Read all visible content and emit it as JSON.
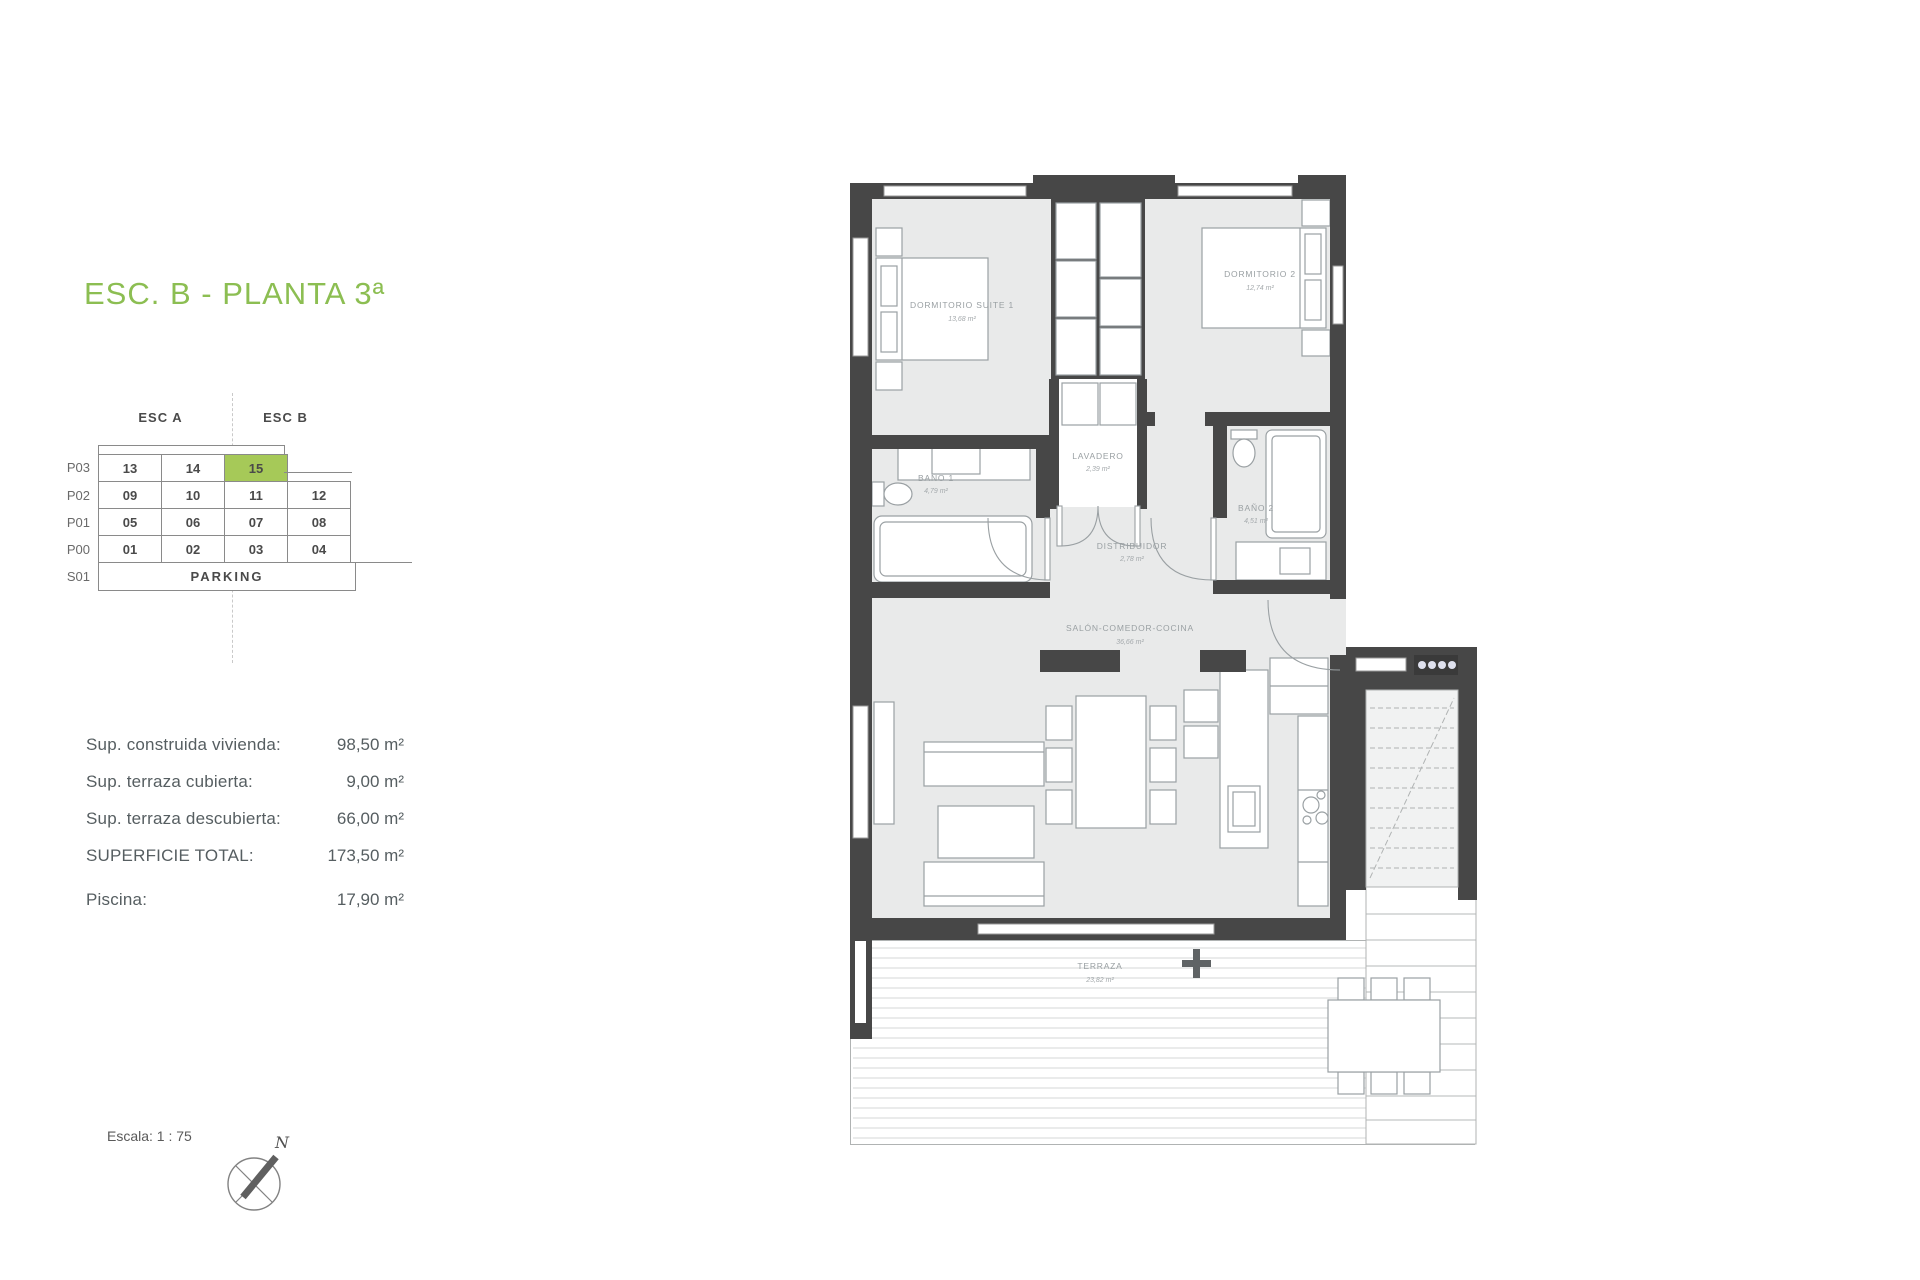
{
  "title": {
    "text": "ESC. B - PLANTA 3ª",
    "color": "#8cbe52"
  },
  "unit_grid": {
    "headers": [
      {
        "label": "ESC A"
      },
      {
        "label": "ESC B"
      }
    ],
    "highlight_color": "#a6c958",
    "rows": [
      {
        "label": "P03",
        "cells": [
          "13",
          "14",
          "15"
        ],
        "highlighted_cell": "15"
      },
      {
        "label": "P02",
        "cells": [
          "09",
          "10",
          "11",
          "12"
        ]
      },
      {
        "label": "P01",
        "cells": [
          "05",
          "06",
          "07",
          "08"
        ]
      },
      {
        "label": "P00",
        "cells": [
          "01",
          "02",
          "03",
          "04"
        ]
      },
      {
        "label": "S01",
        "cells": [
          "PARKING"
        ]
      }
    ]
  },
  "areas": {
    "rows": [
      {
        "label": "Sup. construida vivienda:",
        "value": "98,50 m²"
      },
      {
        "label": "Sup. terraza cubierta:",
        "value": "9,00 m²"
      },
      {
        "label": "Sup. terraza descubierta:",
        "value": "66,00 m²"
      },
      {
        "label": "SUPERFICIE TOTAL:",
        "value": "173,50 m²"
      },
      {
        "label": "Piscina:",
        "value": "17,90 m²"
      }
    ]
  },
  "scale": {
    "text": "Escala: 1 : 75"
  },
  "compass": {
    "north_label": "N"
  },
  "floorplan": {
    "wall_color": "#474747",
    "floor_color": "#e9eaea",
    "rooms": [
      {
        "name": "DORMITORIO SUITE 1",
        "area": "13,68 m²"
      },
      {
        "name": "DORMITORIO 2",
        "area": "12,74 m²"
      },
      {
        "name": "BAÑO 1",
        "area": "4,79 m²"
      },
      {
        "name": "LAVADERO",
        "area": "2,39 m²"
      },
      {
        "name": "BAÑO 2",
        "area": "4,51 m²"
      },
      {
        "name": "DISTRIBUIDOR",
        "area": "2,78 m²"
      },
      {
        "name": "SALÓN-COMEDOR-COCINA",
        "area": "36,66 m²"
      },
      {
        "name": "TERRAZA",
        "area": "23,82 m²"
      }
    ]
  }
}
